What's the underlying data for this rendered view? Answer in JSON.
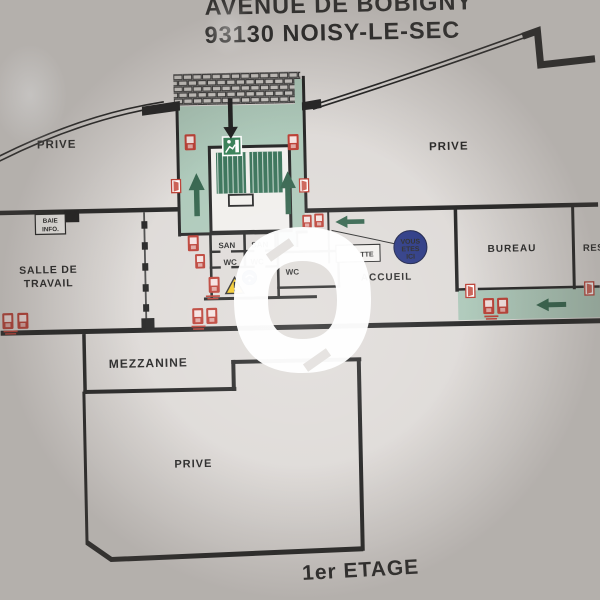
{
  "sign": {
    "address_line1": "AVENUE DE BOBIGNY",
    "address_line2": "93130 NOISY-LE-SEC",
    "floor_label": "1er ETAGE"
  },
  "rooms": {
    "prive_top_left": "PRIVE",
    "prive_top_right": "PRIVE",
    "prive_bottom": "PRIVE",
    "salle_de_travail": [
      "SALLE DE",
      "TRAVAIL"
    ],
    "baie_info": [
      "BAIE",
      "INFO."
    ],
    "mezzanine": "MEZZANINE",
    "accueil": "ACCUEIL",
    "bureau": "BUREAU",
    "reserve_partial": "RESE",
    "san_1": "SAN",
    "san_2": "SAN",
    "wc_1": "WC",
    "wc_2": "WC",
    "wc_3": "WC",
    "label_fragment": "TTE"
  },
  "you_are_here": {
    "line1": "VOUS",
    "line2": "ETES",
    "line3": "ICI"
  },
  "icons": {
    "fire_extinguisher": "red-square-pictogram",
    "emergency_exit_door": "white-door-red-frame",
    "exit_running_man": "green-square-white-figure",
    "warning_triangle": "yellow-triangle-exclamation",
    "info_round_badge": "blue-circle",
    "evacuation_arrow": "solid-green-arrow",
    "entry_arrow": "solid-black-arrow",
    "stairs": "hatched-stair-flight",
    "brick_footbridge": "brick-grid"
  },
  "colors": {
    "wall_black": "#1b1b1b",
    "evac_green": "#a9c6b6",
    "stair_green": "#2e6b50",
    "arrow_green": "#2a5c44",
    "exit_green": "#2f7b50",
    "alarm_red": "#b8352a",
    "here_blue": "#1e2d7d",
    "info_blue": "#1d47a0",
    "warning_yellow": "#f3c61b",
    "panel_grey": "#e3e0dd"
  }
}
